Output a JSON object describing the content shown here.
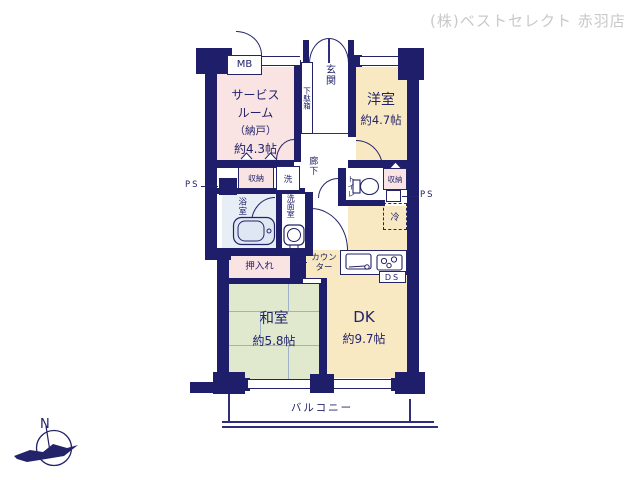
{
  "branding": {
    "company": "(株)ベストセレクト 赤羽店"
  },
  "compass": {
    "north": "N"
  },
  "rooms": {
    "service": {
      "line1": "サービス",
      "line2": "ルーム",
      "line3": "（納戸）",
      "size": "約4.3帖"
    },
    "western": {
      "name": "洋室",
      "size": "約4.7帖"
    },
    "japanese": {
      "name": "和室",
      "size": "約5.8帖"
    },
    "dk": {
      "name": "DK",
      "size": "約9.7帖"
    }
  },
  "labels": {
    "mb": "MB",
    "entrance": "玄関",
    "shoe_cabinet": "下駄箱",
    "hallway": "廊下",
    "storage": "収納",
    "washer": "洗",
    "bathroom": "浴室",
    "washroom": "洗面室",
    "toilet": "トイレ",
    "fridge": "冷",
    "closet": "押入れ",
    "counter1": "カウン",
    "counter2": "ター",
    "ds": "DS",
    "ps": "PS",
    "balcony": "バルコニー"
  },
  "colors": {
    "wall": "#1e1e6b",
    "room_pink": "#f9e3e3",
    "room_cream": "#f8e9c3",
    "room_green": "#e0e9cd",
    "bath_blue": "#e7eef6",
    "line": "#2e2e7a",
    "text": "#23236a",
    "company_gray": "#c9c9c9"
  }
}
